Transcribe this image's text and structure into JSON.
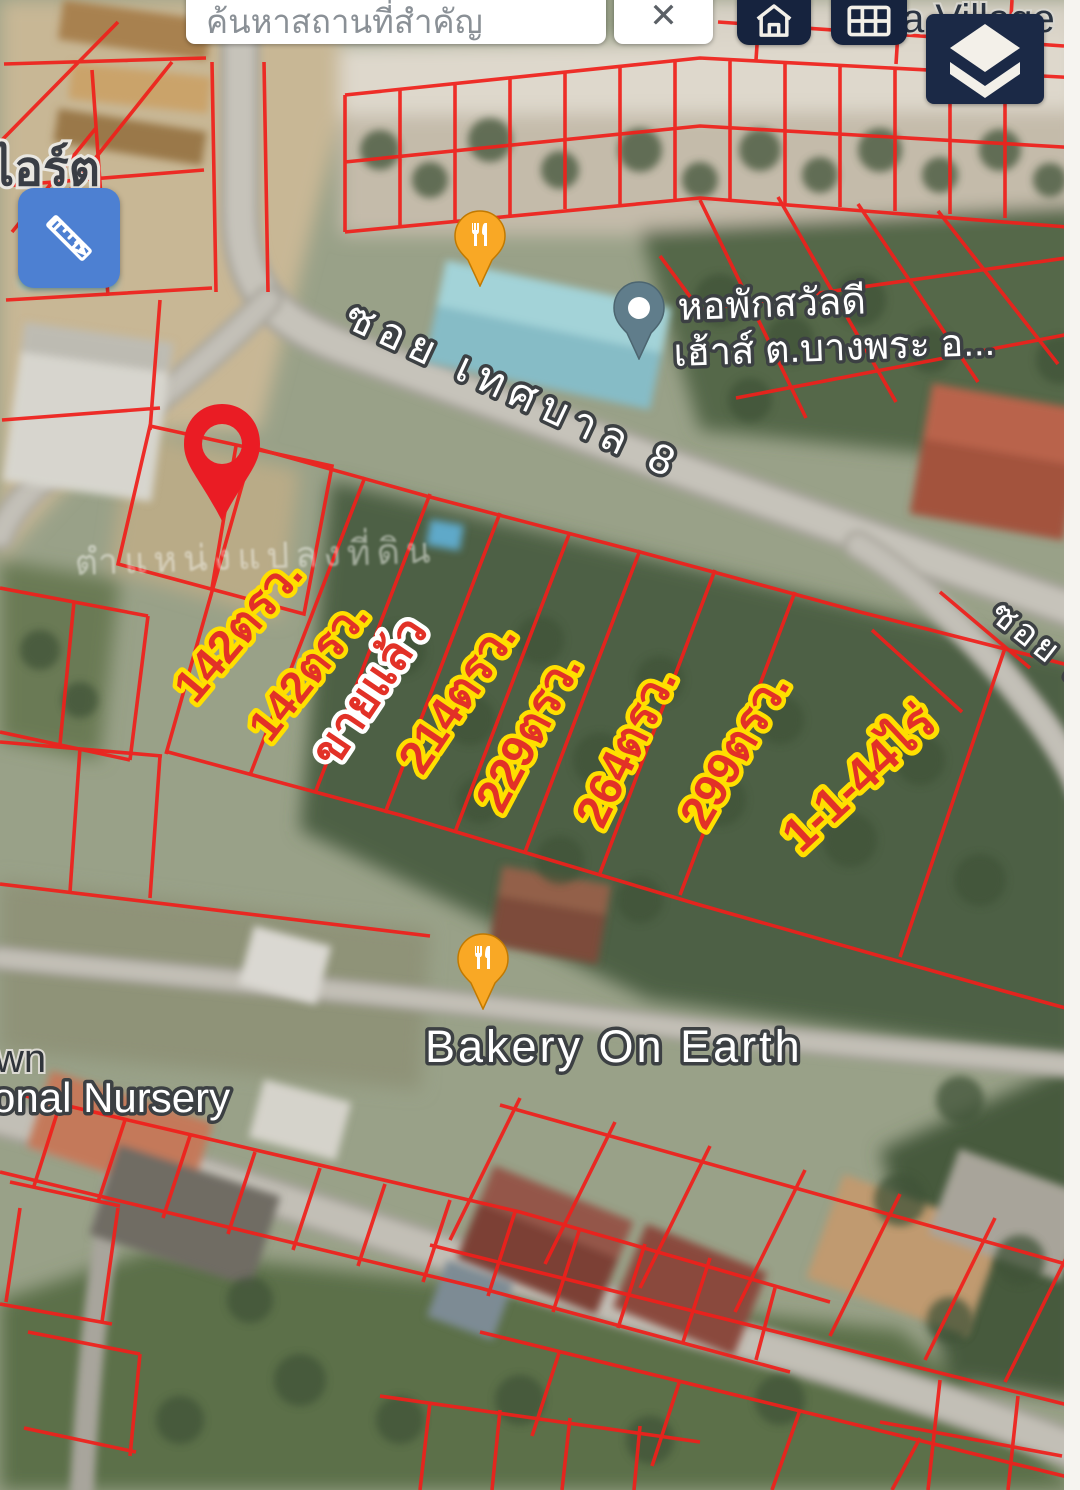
{
  "search": {
    "placeholder": "ค้นหาสถานที่สำคัญ",
    "close": "✕"
  },
  "controls": {
    "home_icon": "home",
    "grid_icon": "keypad-grid",
    "layers_icon": "map-layers",
    "measure_icon": "pencil-ruler"
  },
  "map_labels": {
    "top_left_partial": "ไอร์ต",
    "village_partial": "a Village",
    "road_main": "ซอย เทศบาล 8",
    "road_right": "ซอย เ",
    "dorm_line1": "หอพักสวัลดี",
    "dorm_line2": "เฮ้าส์ ต.บางพระ อ...",
    "bakery": "Bakery On Earth",
    "town_partial": "wn",
    "nursery_partial": "onal Nursery",
    "watermark": "ตำแหน่งแปลงที่ดิน"
  },
  "plots": [
    {
      "label": "142ตรว.",
      "outline": "#ffdf00"
    },
    {
      "label": "142ตรว.",
      "outline": "#ffdf00"
    },
    {
      "label": "ขายแล้ว",
      "outline": "#ffffff"
    },
    {
      "label": "214ตรว.",
      "outline": "#ffdf00"
    },
    {
      "label": "229ตรว.",
      "outline": "#ffdf00"
    },
    {
      "label": "264ตรว.",
      "outline": "#ffdf00"
    },
    {
      "label": "299ตรว.",
      "outline": "#ffdf00"
    },
    {
      "label": "1-1-44ไร่",
      "outline": "#ffdf00"
    }
  ],
  "colors": {
    "parcel_line": "#ef201b",
    "plot_text": "#e23127",
    "plot_outline": "#ffdf00",
    "sold_outline": "#ffffff",
    "button_navy": "#16233e",
    "measure_blue": "#4d80d2",
    "pin_red": "#ea1c24",
    "pin_orange": "#f9a825",
    "pin_slate": "#607d8b",
    "map_label_halo": "#3c4043"
  }
}
